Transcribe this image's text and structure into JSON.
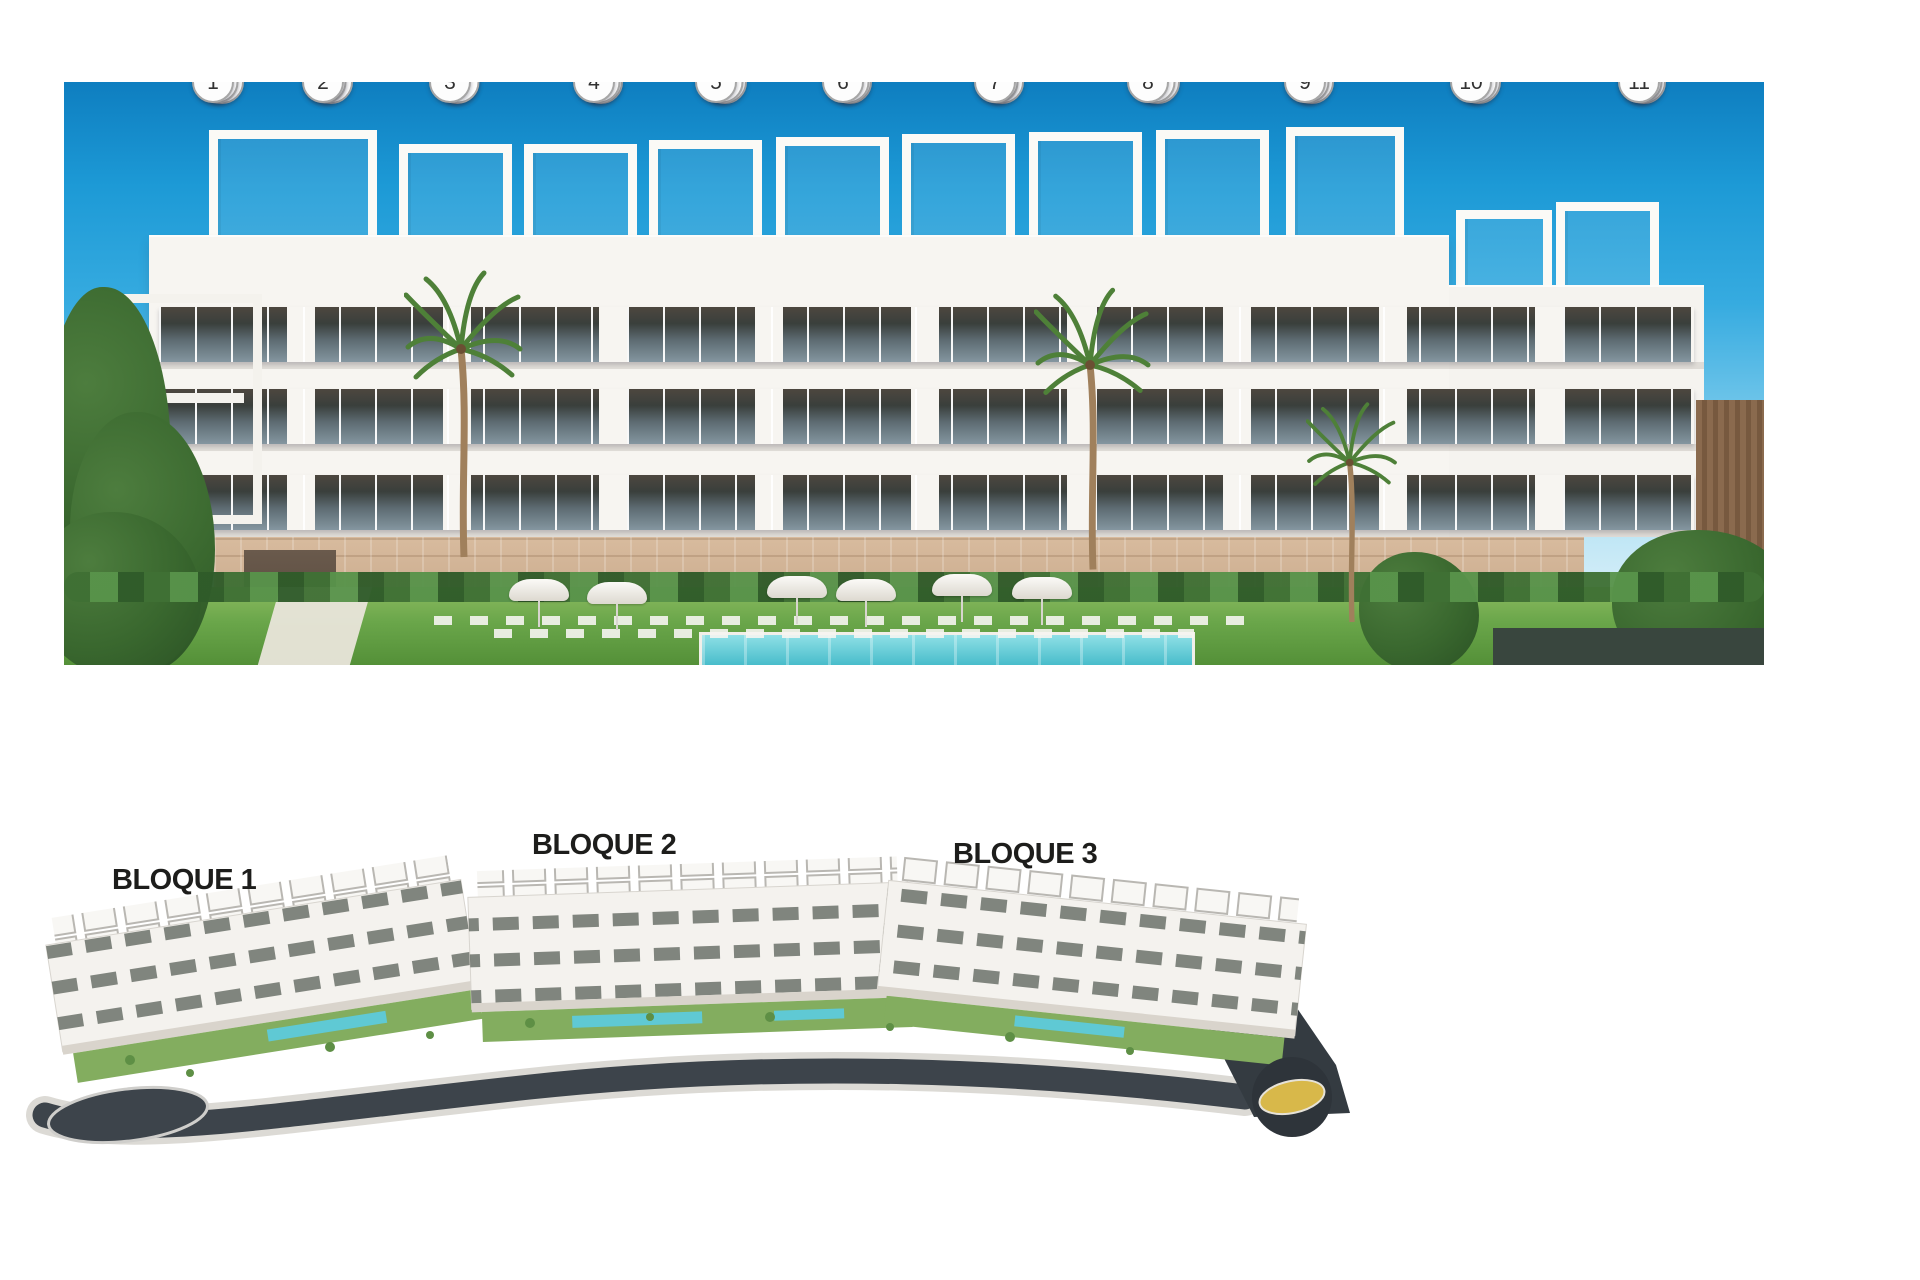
{
  "facade": {
    "description": "Front elevation render with numbered apartment unit badges",
    "rows": [
      {
        "level": "second-floor",
        "y": 336,
        "size": 40,
        "units": [
          {
            "n": "23",
            "x": 222
          },
          {
            "n": "24",
            "x": 331
          },
          {
            "n": "25",
            "x": 457
          },
          {
            "n": "26",
            "x": 601
          },
          {
            "n": "27",
            "x": 725
          },
          {
            "n": "28",
            "x": 850
          },
          {
            "n": "29",
            "x": 1002
          },
          {
            "n": "30",
            "x": 1158
          },
          {
            "n": "31",
            "x": 1312
          },
          {
            "n": "32",
            "x": 1479
          },
          {
            "n": "33",
            "x": 1644
          }
        ]
      },
      {
        "level": "first-floor",
        "y": 415,
        "size": 39,
        "units": [
          {
            "n": "12",
            "x": 217
          },
          {
            "n": "13",
            "x": 325
          },
          {
            "n": "14",
            "x": 458
          },
          {
            "n": "15",
            "x": 599
          },
          {
            "n": "16",
            "x": 722
          },
          {
            "n": "17",
            "x": 848
          },
          {
            "n": "18",
            "x": 997
          },
          {
            "n": "19",
            "x": 1154
          },
          {
            "n": "20",
            "x": 1308
          },
          {
            "n": "21",
            "x": 1476
          },
          {
            "n": "22",
            "x": 1641
          }
        ]
      },
      {
        "level": "ground-floor",
        "y": 502,
        "size": 38,
        "units": [
          {
            "n": "1",
            "x": 213
          },
          {
            "n": "2",
            "x": 323
          },
          {
            "n": "3",
            "x": 450
          },
          {
            "n": "4",
            "x": 594
          },
          {
            "n": "5",
            "x": 716
          },
          {
            "n": "6",
            "x": 843
          },
          {
            "n": "7",
            "x": 995
          },
          {
            "n": "8",
            "x": 1148
          },
          {
            "n": "9",
            "x": 1305
          },
          {
            "n": "10",
            "x": 1471
          },
          {
            "n": "11",
            "x": 1639
          }
        ]
      }
    ]
  },
  "site_plan": {
    "labels": [
      {
        "text": "BLOQUE 1",
        "left": 112,
        "top": 864
      },
      {
        "text": "BLOQUE 2",
        "left": 532,
        "top": 829
      },
      {
        "text": "BLOQUE 3",
        "left": 953,
        "top": 838
      }
    ]
  },
  "colors": {
    "badge_bg": "#fdfdfd",
    "badge_border": "#a6a6a6",
    "badge_text": "#323232",
    "label_text": "#1d1d1b",
    "sky_top": "#0e7ec0",
    "pool": "#41b9c8",
    "grass": "#6aa64a",
    "stone_base": "#c7a685",
    "road_dark": "#3d444b",
    "roundabout_gold": "#d8b84a",
    "dark_box": "#39463e"
  }
}
